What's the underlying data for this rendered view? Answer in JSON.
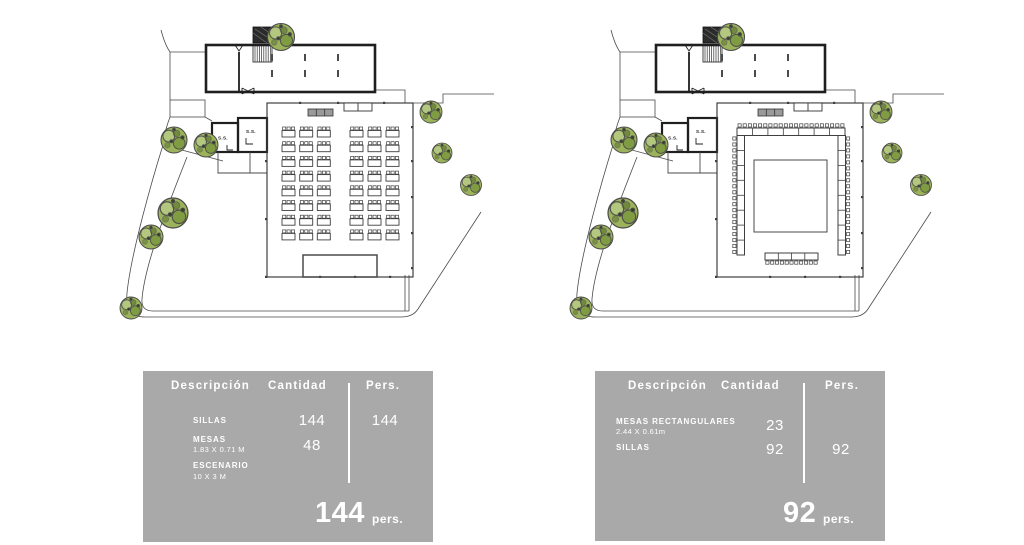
{
  "colors": {
    "panel_bg": "#a9a9a9",
    "panel_text": "#ffffff",
    "line": "#3f3f3f",
    "wall": "#1f1f1f",
    "tree_green": "#9cb35c"
  },
  "site": {
    "bathroom_label": "S.S."
  },
  "plans": [
    {
      "name": "classroom-setup-plan",
      "seating": {
        "type": "classroom",
        "rows": 8,
        "groups": [
          [
            167,
            184.7,
            202.3
          ],
          [
            235,
            253,
            271
          ]
        ],
        "first_row_y": 122,
        "row_pitch": 14.7,
        "table_w": 13,
        "table_h": 6.5,
        "chair_w": 3.2,
        "chair_h": 3,
        "chairs_per_table": 3,
        "tables_total": 48,
        "chairs_total": 144,
        "stage": {
          "x": 188,
          "y": 250,
          "w": 74,
          "h": 22
        }
      }
    },
    {
      "name": "banquet-u-setup-plan",
      "seating": {
        "type": "banquet-u",
        "tables_total": 23,
        "chairs_total": 92,
        "inner": {
          "x": 189,
          "y": 155,
          "w": 73,
          "h": 72
        },
        "top_band": {
          "x": 172,
          "y": 123,
          "len": 108,
          "h": 7.5,
          "segments": 7,
          "chairs": 21
        },
        "left_band": {
          "x": 172,
          "y": 130.5,
          "len": 119.5,
          "h": 7.5,
          "segments": 8,
          "chairs": 20
        },
        "right_band": {
          "x": 273,
          "y": 130.5,
          "len": 119.5,
          "h": 7.5,
          "segments": 8,
          "chairs": 20
        },
        "head_table": {
          "x": 200,
          "y": 248,
          "len": 53,
          "h": 7,
          "segments": 4,
          "chairs": 11
        }
      }
    }
  ],
  "panels": [
    {
      "headers": {
        "description": "Descripción",
        "quantity": "Cantidad",
        "persons": "Pers."
      },
      "rows": [
        {
          "name": "SILLAS",
          "detail": "",
          "qty": "144",
          "pers": "144"
        },
        {
          "name": "MESAS",
          "detail": "1.83 X 0.71 M",
          "qty": "48",
          "pers": ""
        },
        {
          "name": "ESCENARIO",
          "detail": "10 X 3 M",
          "qty": "",
          "pers": ""
        }
      ],
      "total": {
        "value": "144",
        "unit": "pers."
      }
    },
    {
      "headers": {
        "description": "Descripción",
        "quantity": "Cantidad",
        "persons": "Pers."
      },
      "rows": [
        {
          "name": "MESAS RECTANGULARES",
          "detail": "2.44 X 0.61m",
          "qty": "23",
          "pers": ""
        },
        {
          "name": "SILLAS",
          "detail": "",
          "qty": "92",
          "pers": "92"
        }
      ],
      "total": {
        "value": "92",
        "unit": "pers."
      }
    }
  ]
}
